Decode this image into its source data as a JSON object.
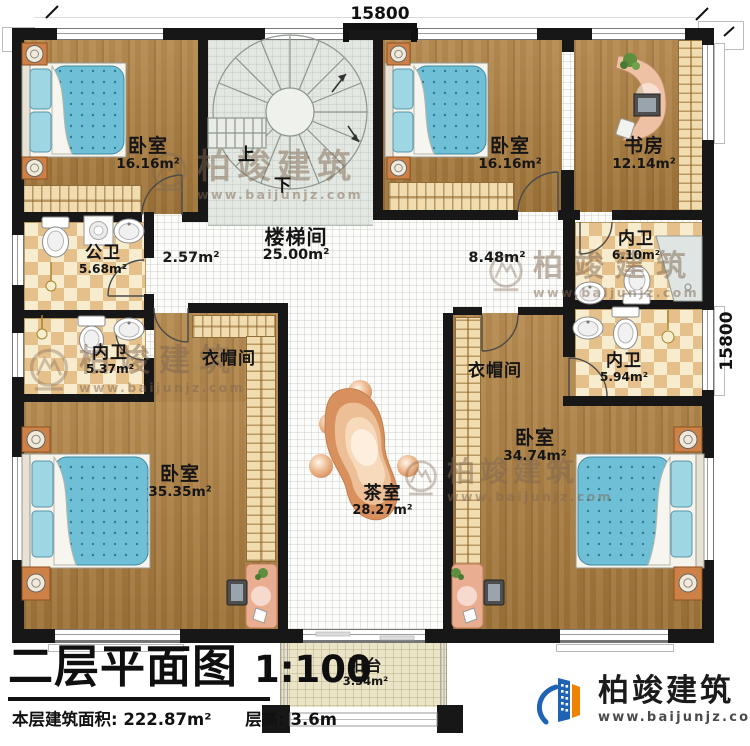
{
  "plan": {
    "dim_top": "15800",
    "dim_right": "15800",
    "stairs_up": "上",
    "stairs_down": "下",
    "corridor_left_area": "2.57m²",
    "corridor_right_area": "8.48m²"
  },
  "rooms": {
    "bedroom_tl": {
      "name": "卧室",
      "area": "16.16m²"
    },
    "bedroom_tm": {
      "name": "卧室",
      "area": "16.16m²"
    },
    "study": {
      "name": "书房",
      "area": "12.14m²"
    },
    "stairwell": {
      "name": "楼梯间",
      "area": "25.00m²"
    },
    "public_bath": {
      "name": "公卫",
      "area": "5.68m²"
    },
    "bath_left": {
      "name": "内卫",
      "area": "5.37m²"
    },
    "bath_top_right": {
      "name": "内卫",
      "area": "6.10m²"
    },
    "bath_right": {
      "name": "内卫",
      "area": "5.94m²"
    },
    "cloak_left": {
      "name": "衣帽间"
    },
    "cloak_right": {
      "name": "衣帽间"
    },
    "bedroom_bl": {
      "name": "卧室",
      "area": "35.35m²"
    },
    "bedroom_br": {
      "name": "卧室",
      "area": "34.74m²"
    },
    "tea_room": {
      "name": "茶室",
      "area": "28.27m²"
    },
    "balcony": {
      "name": "阳台",
      "area": "3.54m²"
    }
  },
  "title_block": {
    "title": "二层平面图",
    "scale": "1:100",
    "area_line": "本层建筑面积: 222.87m²",
    "height_line": "层高: 3.6m"
  },
  "brand": {
    "name": "柏竣建筑",
    "url": "www.baijunjz.com"
  },
  "watermark": {
    "name": "柏竣建筑",
    "url": "www.baijunjz.com"
  },
  "colors": {
    "brand_blue": "#1f63b5",
    "brand_orange": "#ef8200",
    "wall": "#171717"
  }
}
